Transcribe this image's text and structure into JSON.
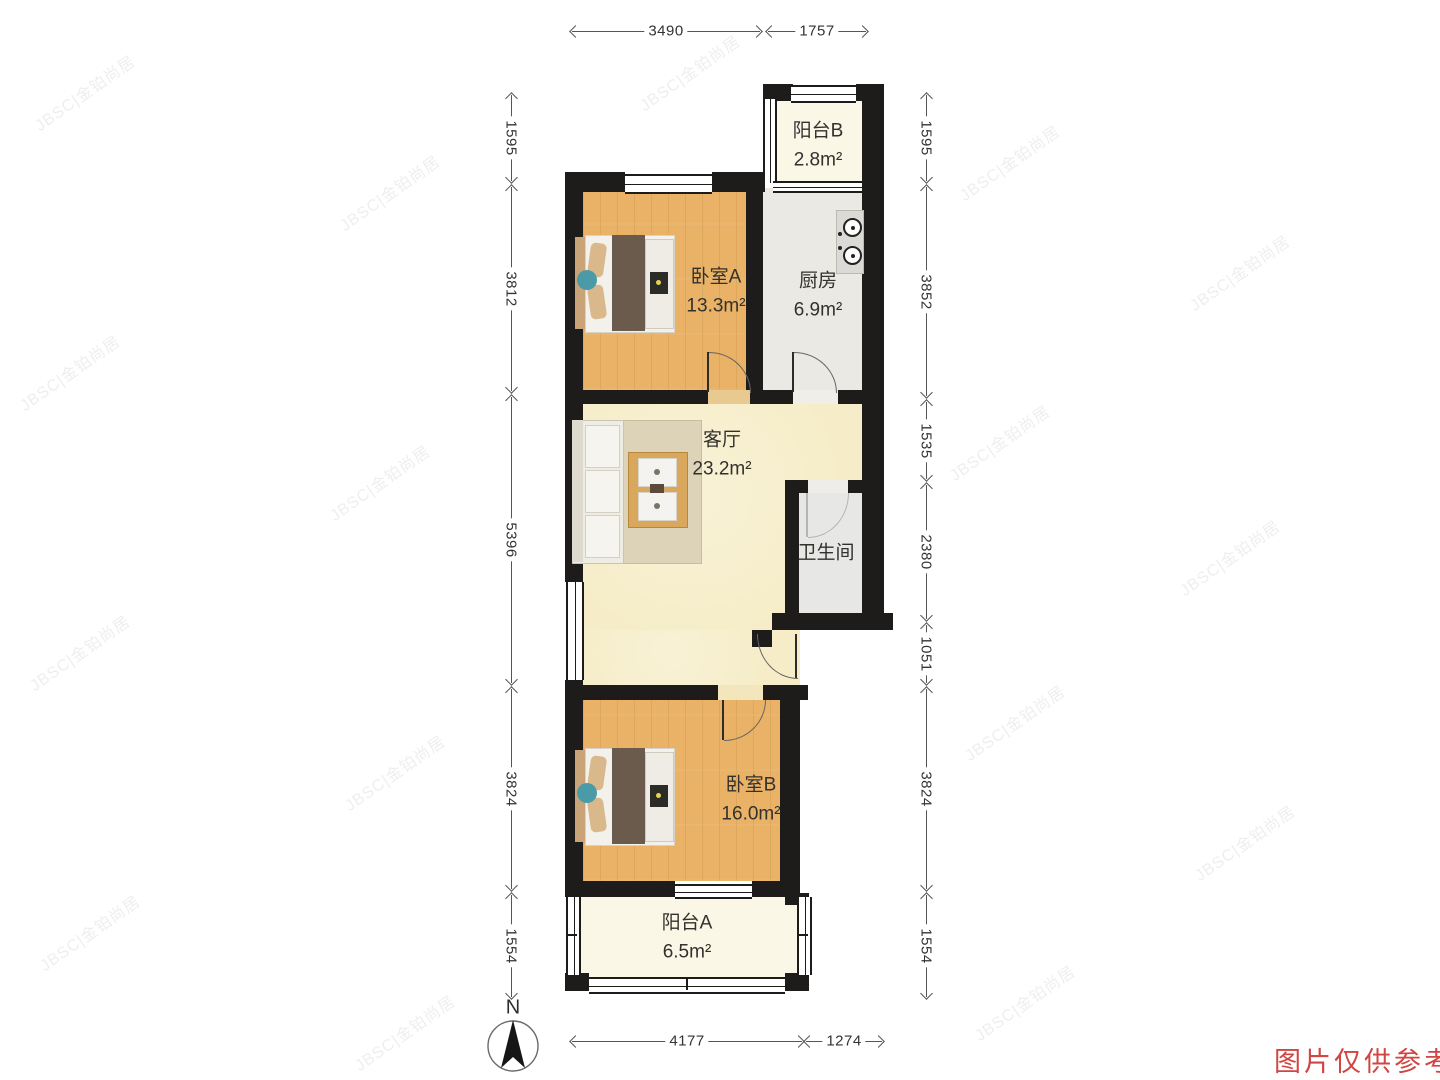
{
  "page": {
    "disclaimer": "图片仅供参考",
    "compass": "N"
  },
  "watermark": "JBSC|金铂尚居",
  "rooms": [
    {
      "name": "阳台B",
      "area": "2.8m²"
    },
    {
      "name": "卧室A",
      "area": "13.3m²"
    },
    {
      "name": "厨房",
      "area": "6.9m²"
    },
    {
      "name": "客厅",
      "area": "23.2m²"
    },
    {
      "name": "卫生间",
      "area": ""
    },
    {
      "name": "卧室B",
      "area": "16.0m²"
    },
    {
      "name": "阳台A",
      "area": "6.5m²"
    }
  ],
  "dimensions": {
    "top": [
      "3490",
      "1757"
    ],
    "bottom": [
      "4177",
      "1274"
    ],
    "left": [
      "1595",
      "3812",
      "5396",
      "3824",
      "1554"
    ],
    "right": [
      "1595",
      "3852",
      "1535",
      "2380",
      "1051",
      "3824",
      "1554"
    ]
  },
  "colors": {
    "wall": "#1d1c1a",
    "wood_floor": "#e9b266",
    "living_floor": "#f6edc8",
    "kitchen_floor": "#ebe9e4",
    "bath_floor": "#e7e7e5",
    "balcony_floor": "#faf7e6",
    "dimension_line": "#555555",
    "label_text": "#33312e",
    "disclaimer_red": "#d14543"
  }
}
